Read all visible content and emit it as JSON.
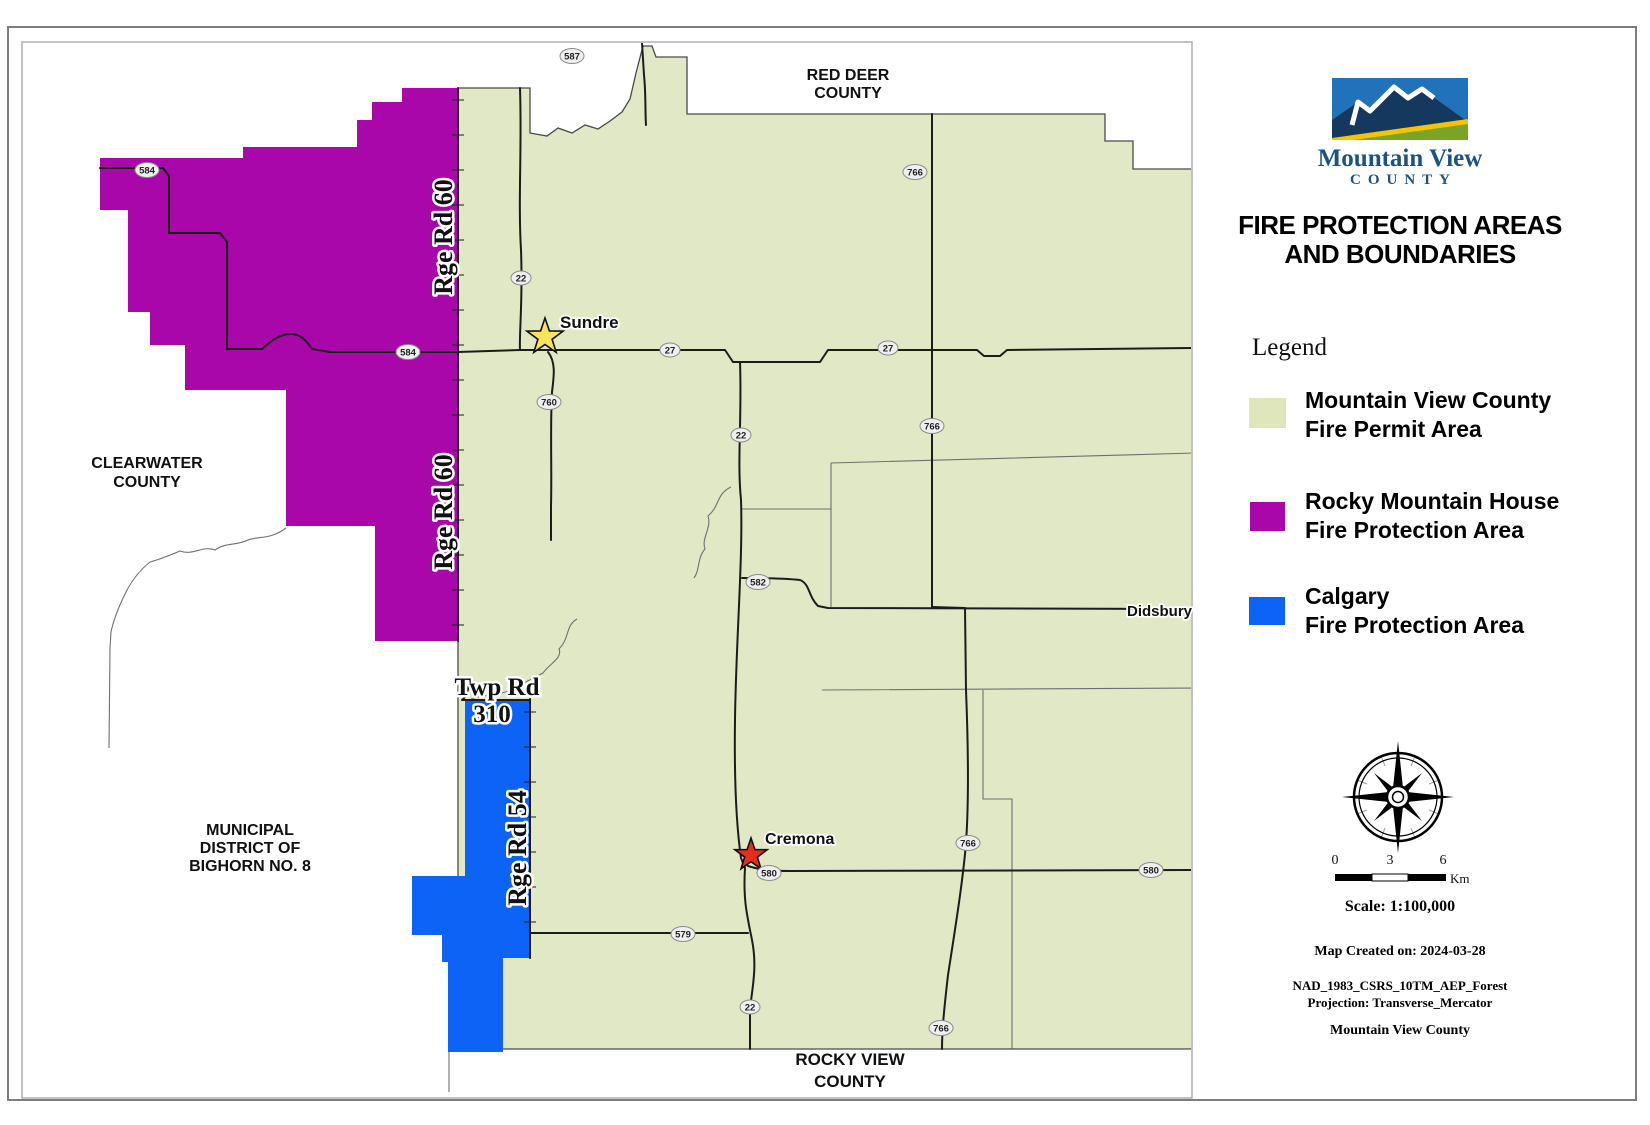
{
  "map": {
    "areas": {
      "red_deer": [
        "RED DEER",
        "COUNTY"
      ],
      "clearwater": [
        "CLEARWATER",
        "COUNTY"
      ],
      "bighorn": [
        "MUNICIPAL",
        "DISTRICT OF",
        "BIGHORN NO. 8"
      ],
      "rocky_view": [
        "ROCKY VIEW",
        "COUNTY"
      ]
    },
    "places": {
      "sundre": "Sundre",
      "cremona": "Cremona",
      "didsbury": "Didsbury"
    },
    "road_labels": {
      "rge_rd_60_n": "Rge Rd 60",
      "rge_rd_60_s": "Rge Rd 60",
      "rge_rd_54": "Rge Rd 54",
      "twp_rd": "Twp Rd",
      "twp_rd_num": "310"
    },
    "shields": [
      "587",
      "584",
      "584",
      "22",
      "27",
      "27",
      "760",
      "766",
      "766",
      "22",
      "582",
      "766",
      "580",
      "580",
      "579",
      "22",
      "766"
    ]
  },
  "sidebar": {
    "logo": {
      "title": "Mountain View",
      "subtitle": "COUNTY"
    },
    "title_lines": [
      "FIRE PROTECTION AREAS",
      "AND BOUNDARIES"
    ],
    "legend": {
      "heading": "Legend",
      "items": [
        {
          "color": "#dfe6bc",
          "label_lines": [
            "Mountain View County",
            "Fire Permit Area"
          ]
        },
        {
          "color": "#a907a9",
          "label_lines": [
            "Rocky Mountain House",
            "Fire Protection Area"
          ]
        },
        {
          "color": "#0e63f7",
          "label_lines": [
            "Calgary",
            "Fire Protection Area"
          ]
        }
      ]
    },
    "scalebar": {
      "ticks": [
        "0",
        "3",
        "6"
      ],
      "unit": "Km",
      "scale_text": "Scale: 1:100,000"
    },
    "created": "Map Created on: 2024-03-28",
    "projection_lines": [
      "NAD_1983_CSRS_10TM_AEP_Forest",
      "Projection: Transverse_Mercator"
    ],
    "footer": "Mountain View County"
  },
  "colors": {
    "fire_permit_area": "#dfe6bc",
    "rocky_mountain_house_area": "#a907a9",
    "calgary_area": "#0e63f7",
    "map_green": "#e0e8c6",
    "road": "#1c1c1c",
    "boundary": "#6f6f6f",
    "logo_navy": "#1b5382"
  }
}
